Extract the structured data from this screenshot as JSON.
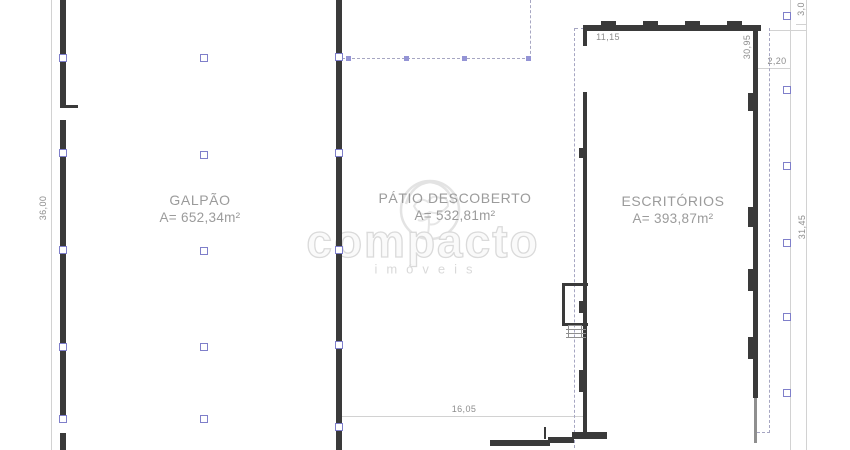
{
  "areas": [
    {
      "name": "GALPÃO",
      "area": "A= 652,34m²"
    },
    {
      "name": "PÁTIO DESCOBERTO",
      "area": "A= 532,81m²"
    },
    {
      "name": "ESCRITÓRIOS",
      "area": "A= 393,87m²"
    }
  ],
  "dimension_labels": [
    {
      "text": "36,00",
      "x": 43,
      "y": 208,
      "rot": true
    },
    {
      "text": "11,15",
      "x": 608,
      "y": 37,
      "rot": false
    },
    {
      "text": "30,95",
      "x": 747,
      "y": 47,
      "rot": true
    },
    {
      "text": "2,20",
      "x": 777,
      "y": 61,
      "rot": false
    },
    {
      "text": "3,0",
      "x": 801,
      "y": 9,
      "rot": true
    },
    {
      "text": "31,45",
      "x": 802,
      "y": 227,
      "rot": true
    },
    {
      "text": "16,05",
      "x": 464,
      "y": 409,
      "rot": false
    }
  ],
  "watermark": {
    "brand": "compacto",
    "tagline": "imóveis"
  },
  "colors": {
    "wall": "#3a3a3a",
    "light_wall": "#8f8f8f",
    "dimension_line": "#d2d2d2",
    "dashed_line": "#a6a6c2",
    "marker_border": "#7f7fca",
    "marker_fill": "#ffffff",
    "small_marker": "#9494d5",
    "area_text": "#9b9b9b",
    "dimension_text": "#8d8d8d",
    "watermark": "#dadada",
    "background": "#ffffff"
  },
  "geometry": {
    "walls": [
      [
        60,
        0,
        6,
        107
      ],
      [
        60,
        105,
        18,
        3
      ],
      [
        60,
        120,
        6,
        300
      ],
      [
        60,
        433,
        6,
        17
      ],
      [
        336,
        0,
        6,
        450
      ],
      [
        583,
        25,
        178,
        6
      ],
      [
        601,
        21,
        15,
        4
      ],
      [
        643,
        21,
        15,
        4
      ],
      [
        685,
        21,
        15,
        4
      ],
      [
        727,
        21,
        15,
        4
      ],
      [
        583,
        31,
        4,
        15
      ],
      [
        583,
        92,
        4,
        341
      ],
      [
        753,
        25,
        5,
        373
      ],
      [
        490,
        440,
        60,
        6
      ],
      [
        548,
        437,
        26,
        6
      ],
      [
        572,
        432,
        35,
        7
      ],
      [
        544,
        427,
        2,
        12
      ],
      [
        562,
        283,
        3,
        43
      ],
      [
        562,
        283,
        26,
        3
      ],
      [
        562,
        323,
        26,
        3
      ],
      [
        748,
        93,
        5,
        18
      ],
      [
        748,
        207,
        5,
        20
      ],
      [
        748,
        269,
        5,
        22
      ],
      [
        748,
        337,
        5,
        22
      ],
      [
        579,
        148,
        4,
        10
      ],
      [
        579,
        301,
        4,
        12
      ],
      [
        579,
        370,
        4,
        22
      ]
    ],
    "light_walls": [
      [
        754,
        398,
        3,
        45
      ],
      [
        566,
        329,
        20,
        1
      ],
      [
        566,
        333,
        20,
        1
      ],
      [
        566,
        337,
        20,
        1
      ],
      [
        568,
        325,
        14,
        1
      ],
      [
        568,
        325,
        1,
        12
      ],
      [
        581,
        325,
        1,
        12
      ]
    ],
    "thin_lines": [
      [
        51,
        0,
        1,
        450
      ],
      [
        790,
        0,
        1,
        450
      ],
      [
        806,
        0,
        1,
        450
      ],
      [
        341,
        416,
        245,
        1
      ],
      [
        770,
        30,
        37,
        1
      ],
      [
        757,
        68,
        34,
        1
      ],
      [
        796,
        24,
        11,
        1
      ]
    ],
    "dashed_v": [
      [
        530,
        0,
        59
      ],
      [
        574,
        28,
        420
      ],
      [
        769,
        28,
        405
      ]
    ],
    "dashed_h": [
      [
        342,
        58,
        188
      ],
      [
        575,
        28,
        9
      ],
      [
        757,
        432,
        13
      ]
    ],
    "column_markers": [
      [
        63,
        58
      ],
      [
        63,
        153
      ],
      [
        63,
        250
      ],
      [
        63,
        347
      ],
      [
        63,
        419
      ],
      [
        204,
        58
      ],
      [
        204,
        155
      ],
      [
        204,
        251
      ],
      [
        204,
        347
      ],
      [
        204,
        419
      ],
      [
        339,
        57
      ],
      [
        339,
        153
      ],
      [
        339,
        250
      ],
      [
        339,
        345
      ],
      [
        339,
        427
      ],
      [
        787,
        16
      ],
      [
        787,
        90
      ],
      [
        787,
        166
      ],
      [
        787,
        243
      ],
      [
        787,
        317
      ],
      [
        787,
        393
      ]
    ],
    "small_markers": [
      [
        348,
        58
      ],
      [
        406,
        58
      ],
      [
        464,
        58
      ],
      [
        528,
        58
      ]
    ]
  }
}
